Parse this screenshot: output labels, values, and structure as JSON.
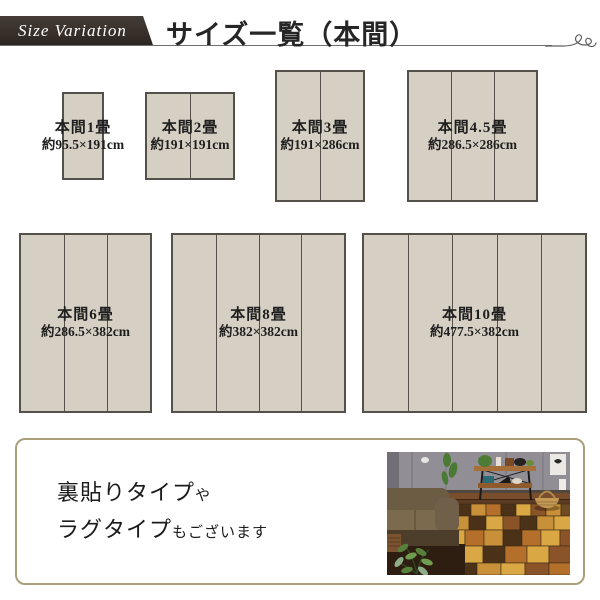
{
  "header": {
    "badge_label": "Size Variation",
    "title": "サイズ一覧（本間）"
  },
  "sizes": [
    {
      "name": "本間1畳",
      "dims": "約95.5×191cm",
      "panels": 1
    },
    {
      "name": "本間2畳",
      "dims": "約191×191cm",
      "panels": 2
    },
    {
      "name": "本間3畳",
      "dims": "約191×286cm",
      "panels": 2
    },
    {
      "name": "本間4.5畳",
      "dims": "約286.5×286cm",
      "panels": 3
    },
    {
      "name": "本間6畳",
      "dims": "約286.5×382cm",
      "panels": 3
    },
    {
      "name": "本間8畳",
      "dims": "約382×382cm",
      "panels": 4
    },
    {
      "name": "本間10畳",
      "dims": "約477.5×382cm",
      "panels": 5
    }
  ],
  "note": {
    "line1_big": "裏貼りタイプ",
    "line1_small": "や",
    "line2_big": "ラグタイプ",
    "line2_small": "もございます"
  },
  "colors": {
    "badge_bg": "#37302b",
    "badge_text": "#ffffff",
    "title_text": "#262626",
    "header_rule": "#6e6e6e",
    "mat_fill": "#d6d0c4",
    "mat_border": "#54504a",
    "note_border": "#ab9e7b",
    "rug_palette": [
      "#b4702a",
      "#d9a845",
      "#4a3118",
      "#8a5428",
      "#c89038",
      "#6e4a22"
    ]
  }
}
